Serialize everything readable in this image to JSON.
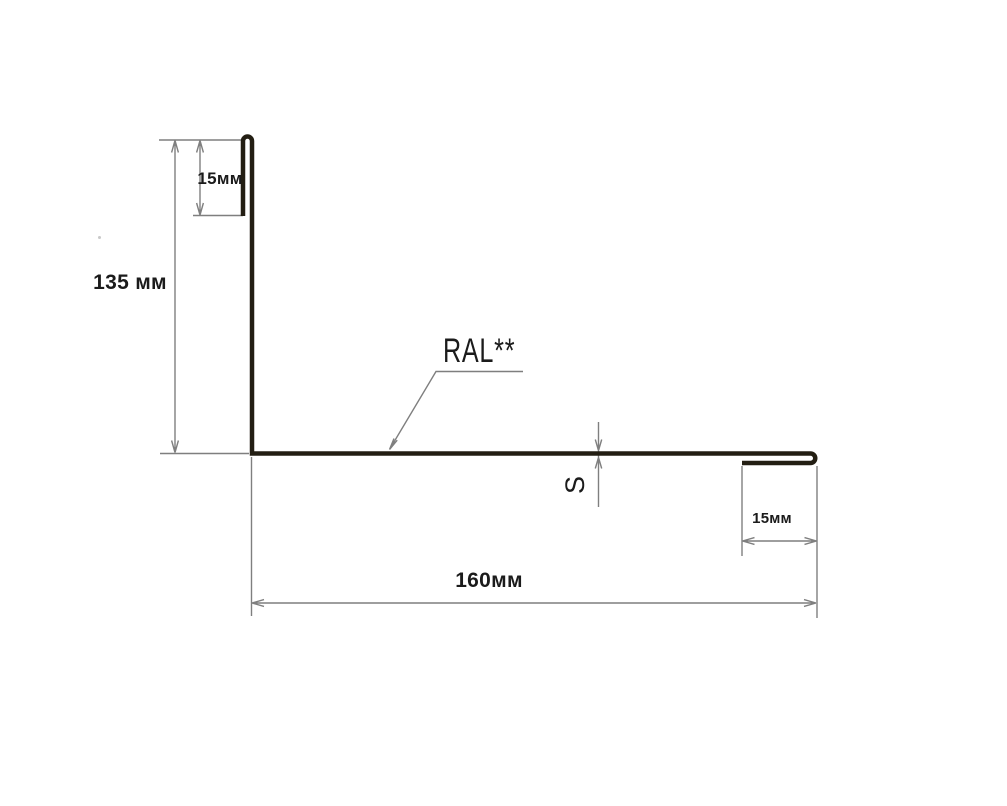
{
  "drawing": {
    "title": "L-shaped metal flashing profile cross-section with dimensions",
    "labels": {
      "top_hem": "15мм",
      "left_leg": "135 мм",
      "coating": "RAL**",
      "thickness": "S",
      "right_hem": "15мм",
      "bottom_leg": "160мм"
    },
    "dimensions": [
      {
        "name": "top-hem-height",
        "label": "15мм"
      },
      {
        "name": "vertical-leg-height",
        "label": "135 мм"
      },
      {
        "name": "sheet-thickness",
        "label": "S"
      },
      {
        "name": "coating-note",
        "label": "RAL**"
      },
      {
        "name": "bottom-hem-length",
        "label": "15мм"
      },
      {
        "name": "horizontal-leg-length",
        "label": "160мм"
      }
    ],
    "colors": {
      "profile_line": "#231e13",
      "dimension_line": "#7f7f7f",
      "text": "#1b1b1b",
      "background": "#ffffff"
    }
  }
}
